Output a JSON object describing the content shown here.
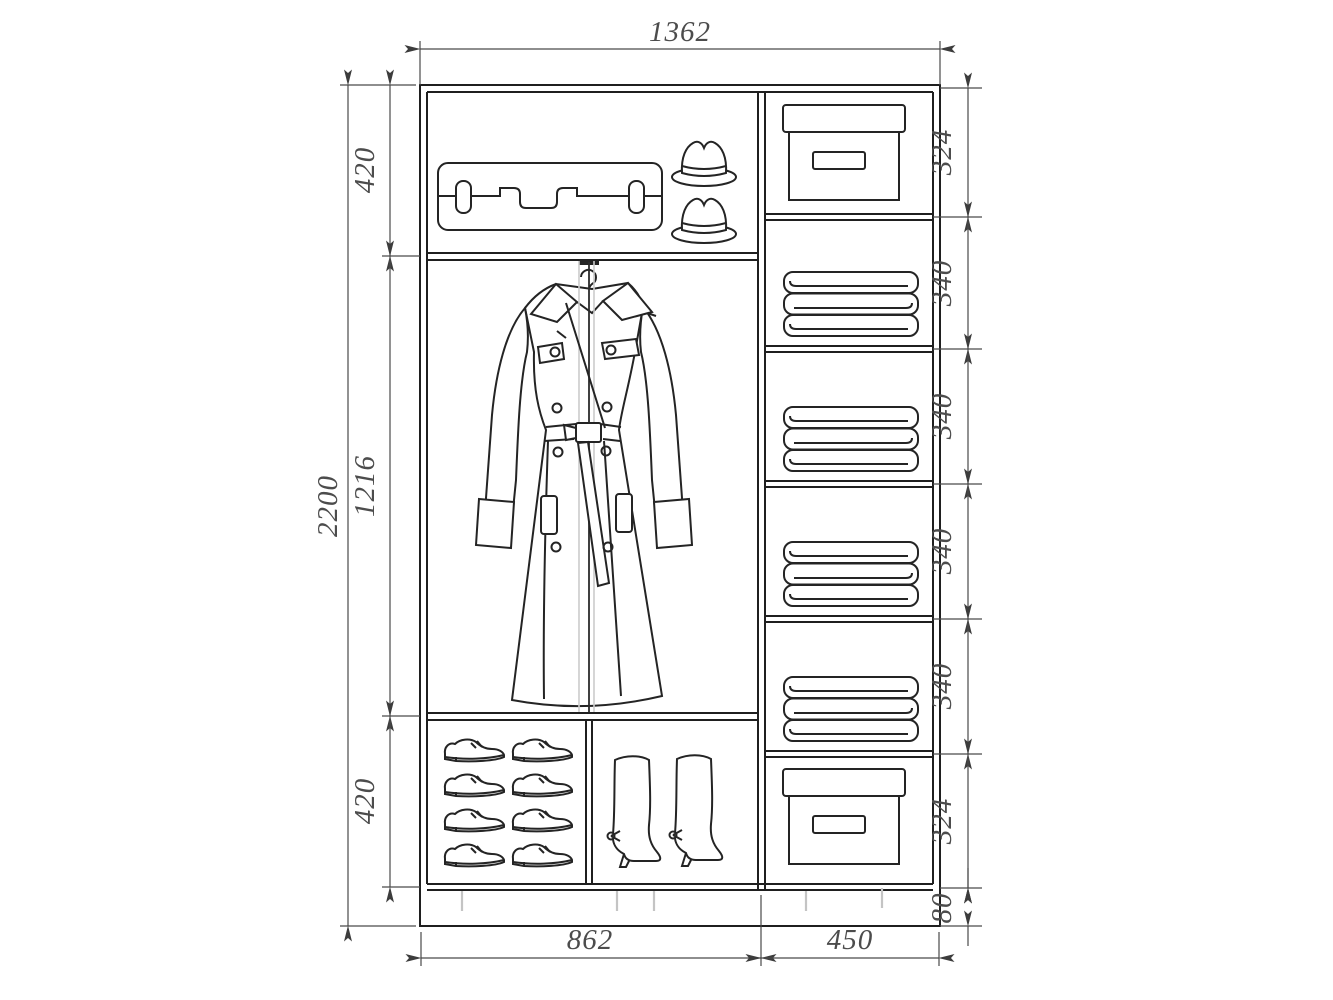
{
  "drawing": {
    "type": "wardrobe-interior-technical-drawing",
    "units": "mm",
    "colors": {
      "background": "#ffffff",
      "cabinet_line": "#1f1f1f",
      "dimension_line": "#4a4a4a",
      "dimension_text": "#4c4c4c",
      "light_gray_detail": "#c4c4c4"
    },
    "dims": {
      "total_width": "1362",
      "total_height": "2200",
      "left_sections": [
        "420",
        "1216",
        "420"
      ],
      "right_sections": [
        "324",
        "340",
        "340",
        "340",
        "340",
        "324",
        "80"
      ],
      "bottom_left_width": "862",
      "bottom_right_width": "450"
    },
    "contents": {
      "top_shelf_items": [
        "suitcase",
        "hat",
        "hat"
      ],
      "middle_section_item": "trench-coat-on-hanger",
      "bottom_left_items": [
        "shoes-grid-of-eight",
        "pair-of-high-boots"
      ],
      "right_column_items": [
        "storage-box",
        "folded-linen-stack",
        "folded-linen-stack",
        "folded-linen-stack",
        "folded-linen-stack",
        "storage-box"
      ]
    }
  }
}
